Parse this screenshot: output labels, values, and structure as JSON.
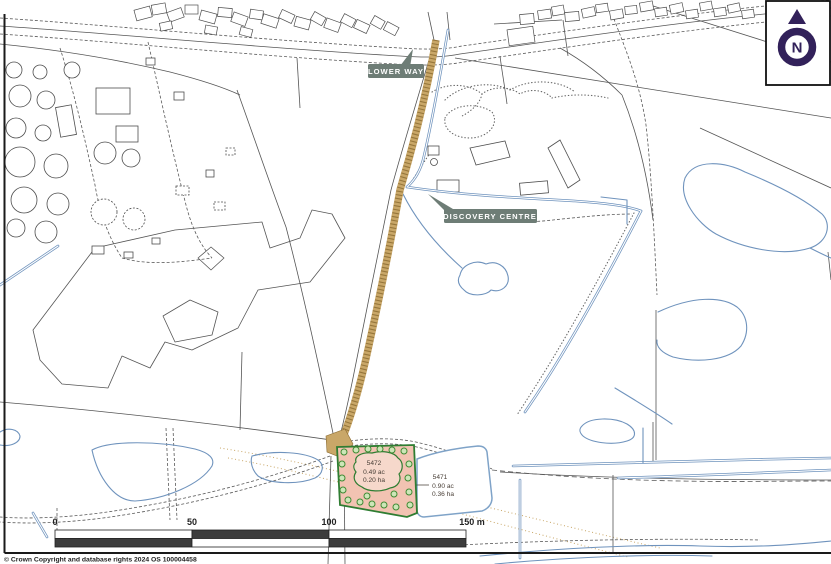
{
  "map": {
    "labels": {
      "lower_way": "LOWER WAY",
      "discovery_centre": "DISCOVERY CENTRE"
    },
    "parcels": [
      {
        "id": "5472",
        "area_ac": "0.49 ac",
        "area_ha": "0.20 ha"
      },
      {
        "id": "5471",
        "area_ac": "0.90 ac",
        "area_ha": "0.36 ha"
      }
    ],
    "north_indicator": {
      "letter": "N"
    },
    "scale_bar": {
      "ticks": [
        "0",
        "50",
        "100",
        "150 m"
      ]
    },
    "attribution": "© Crown Copyright and database rights 2024 OS 100004458",
    "colors": {
      "water": "#6f93bd",
      "track_fill": "#c9a768",
      "track_hatch": "#8a6a30",
      "parcel_highlight": "#f2c3b2",
      "parcel_inner": "#f6d8cb",
      "parcel_boundary_green": "#2f7d32",
      "tree_green": "#3f8a33",
      "parcel_outline_blue": "#7fa3c8",
      "callout_box": "#6e7d76",
      "north_symbol": "#32215a",
      "map_line": "#555555"
    }
  }
}
